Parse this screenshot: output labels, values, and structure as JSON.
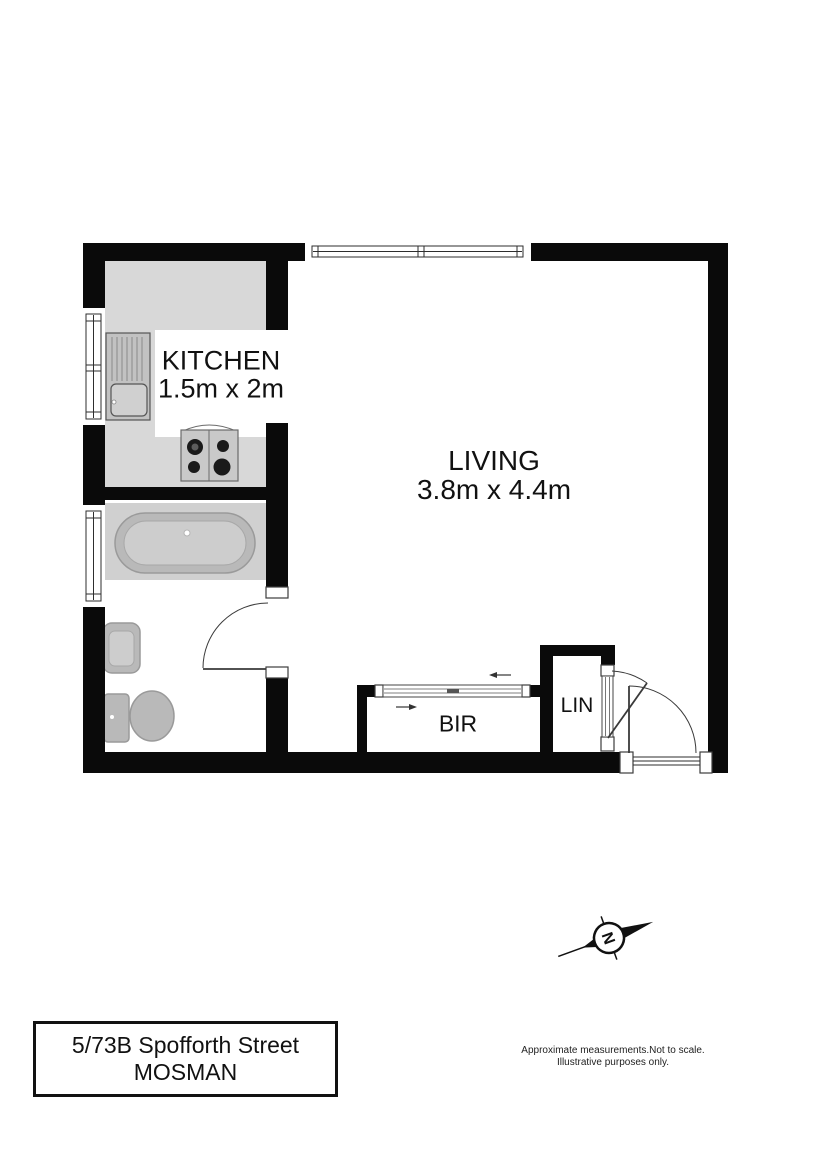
{
  "floorplan": {
    "rooms": {
      "kitchen": {
        "label": "KITCHEN",
        "dimensions": "1.5m x 2m"
      },
      "living": {
        "label": "LIVING",
        "dimensions": "3.8m x 4.4m"
      },
      "bir": {
        "label": "BIR"
      },
      "lin": {
        "label": "LIN"
      }
    },
    "compass": {
      "north_label": "N"
    }
  },
  "title_block": {
    "address_line1": "5/73B Spofforth Street",
    "address_line2": "MOSMAN"
  },
  "disclaimer": {
    "line1": "Approximate measurements.Not to scale.",
    "line2": "Illustrative purposes only."
  },
  "colors": {
    "wall": "#0a0a0a",
    "counter": "#d8d8d8",
    "tub-block": "#d0d0d0",
    "fixture": "#b9b9b9",
    "door": "#3a3a3a"
  }
}
